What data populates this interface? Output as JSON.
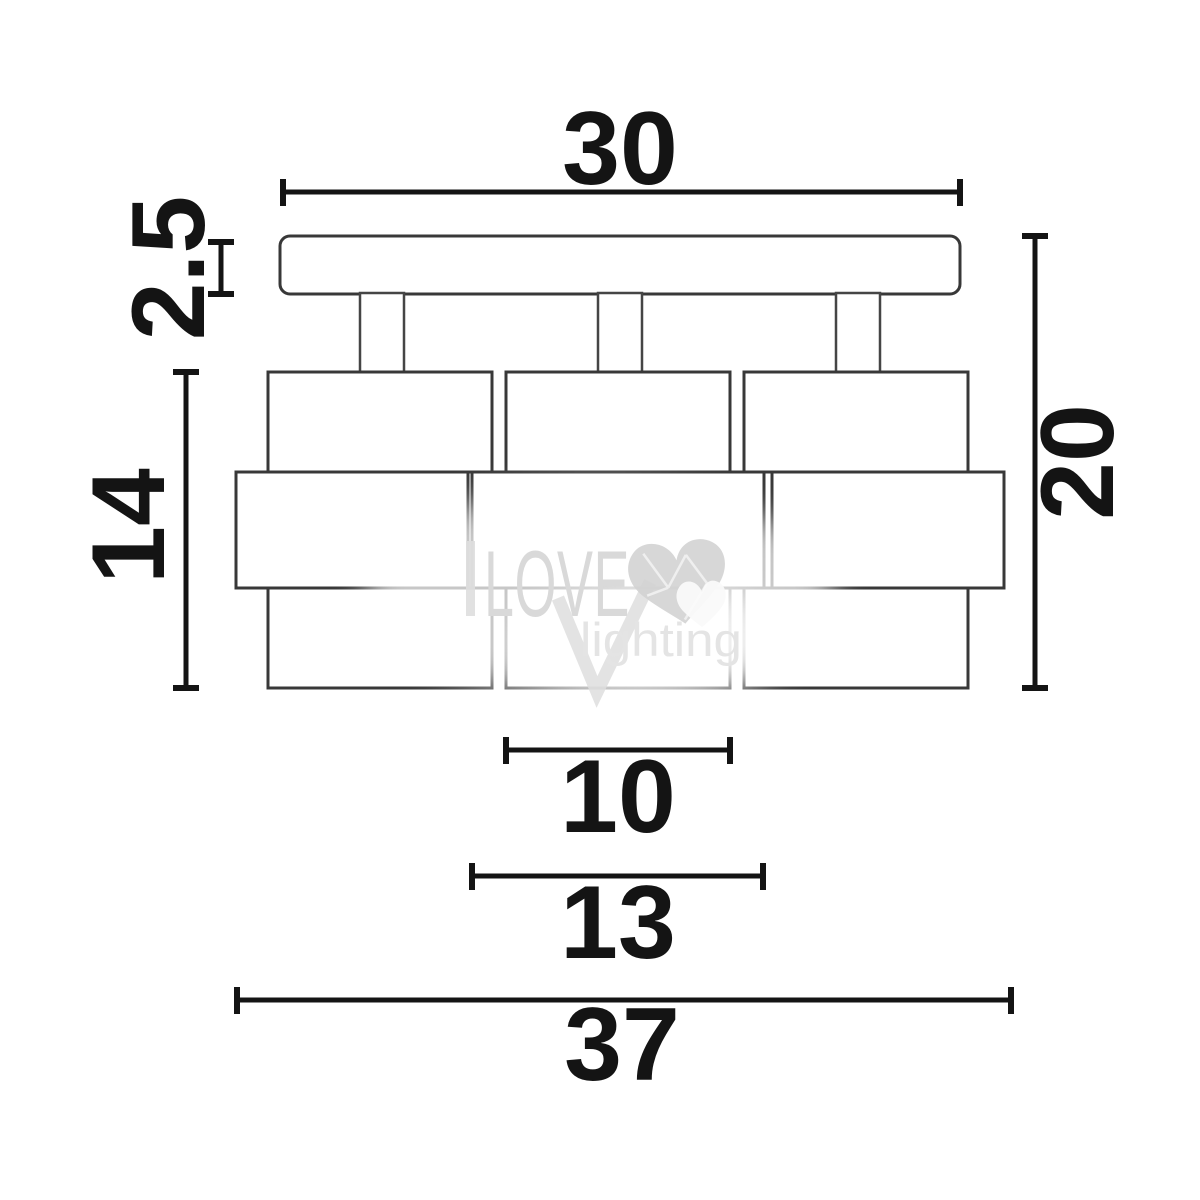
{
  "dimensions": {
    "plate_width": "30",
    "plate_thickness": "2.5",
    "shade_height": "14",
    "fixture_height": "20",
    "shade_top_width": "10",
    "shade_band_width": "13",
    "fixture_width": "37"
  },
  "watermark": {
    "brand": "LOVE",
    "tagline": "lighting",
    "heart_icon": "faceted-heart-icon",
    "text_color": "#d9d9d9",
    "heart_color": "#d2d2d2"
  },
  "drawing": {
    "line_color": "#141414",
    "outline_color": "#383838",
    "background": "#ffffff"
  }
}
